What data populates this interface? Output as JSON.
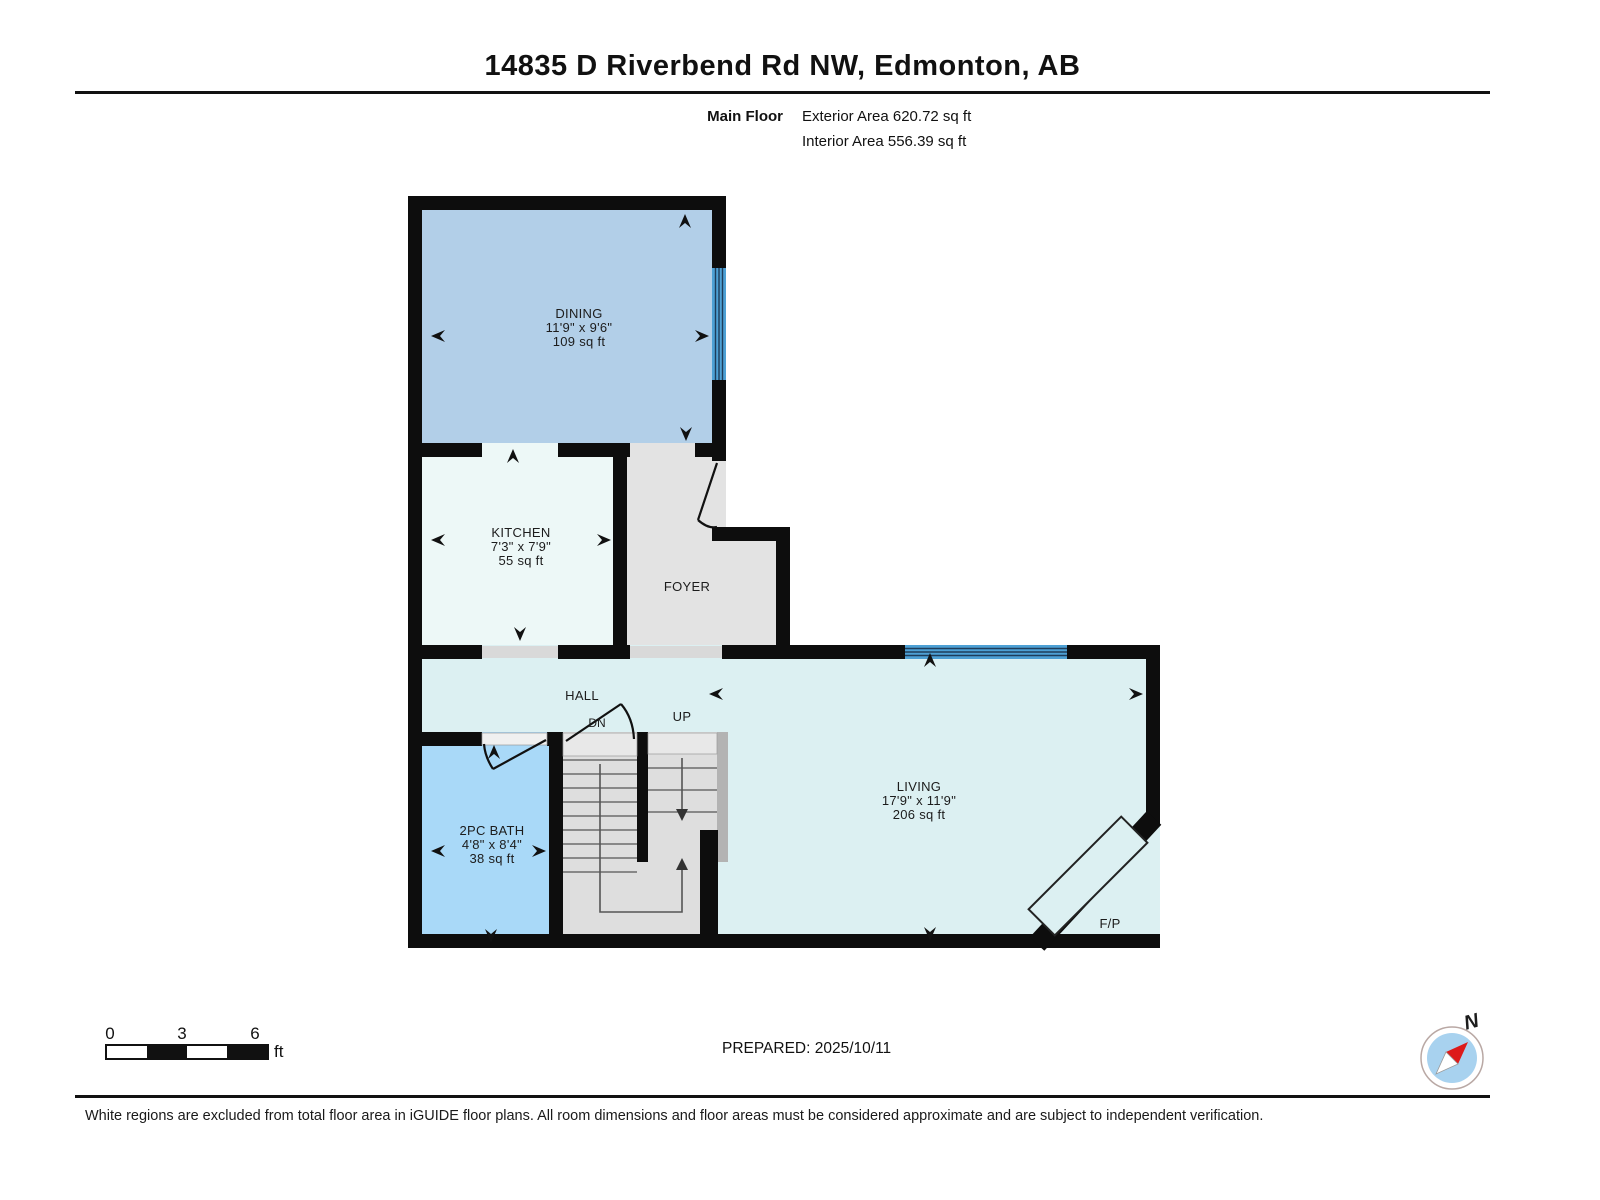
{
  "header": {
    "title": "14835 D Riverbend Rd NW, Edmonton, AB",
    "floor_label": "Main Floor",
    "exterior_area": "Exterior Area 620.72 sq ft",
    "interior_area": "Interior Area 556.39 sq ft"
  },
  "rooms": {
    "dining": {
      "name": "DINING",
      "dims": "11'9\" x 9'6\"",
      "area": "109 sq ft"
    },
    "kitchen": {
      "name": "KITCHEN",
      "dims": "7'3\" x 7'9\"",
      "area": "55 sq ft"
    },
    "foyer": {
      "name": "FOYER"
    },
    "hall": {
      "name": "HALL"
    },
    "bath": {
      "name": "2PC BATH",
      "dims": "4'8\" x 8'4\"",
      "area": "38 sq ft"
    },
    "living": {
      "name": "LIVING",
      "dims": "17'9\" x 11'9\"",
      "area": "206 sq ft"
    },
    "stairs": {
      "down_label": "DN",
      "up_label": "UP"
    },
    "fireplace_label": "F/P"
  },
  "scale_bar": {
    "ticks": [
      "0",
      "3",
      "6"
    ],
    "unit": "ft"
  },
  "footer": {
    "prepared": "PREPARED: 2025/10/11",
    "disclaimer": "White regions are excluded from total floor area in iGUIDE floor plans. All room dimensions and floor areas must be considered approximate and are subject to independent verification."
  },
  "compass": {
    "north_label": "N"
  },
  "colors": {
    "wall": "#0d0d0d",
    "dining_fill": "#b2cfe8",
    "kitchen_fill": "#edf8f7",
    "foyer_fill": "#e3e3e3",
    "hall_living_fill": "#dcf0f2",
    "bath_fill": "#a9d9f8",
    "window_blue": "#4da0d4",
    "stair_fill": "#dedede",
    "stair_rail": "#b3b3b3",
    "threshold": "#d9d9d9",
    "compass_blue": "#a8d2ef",
    "compass_needle_red": "#dd1a1a"
  }
}
